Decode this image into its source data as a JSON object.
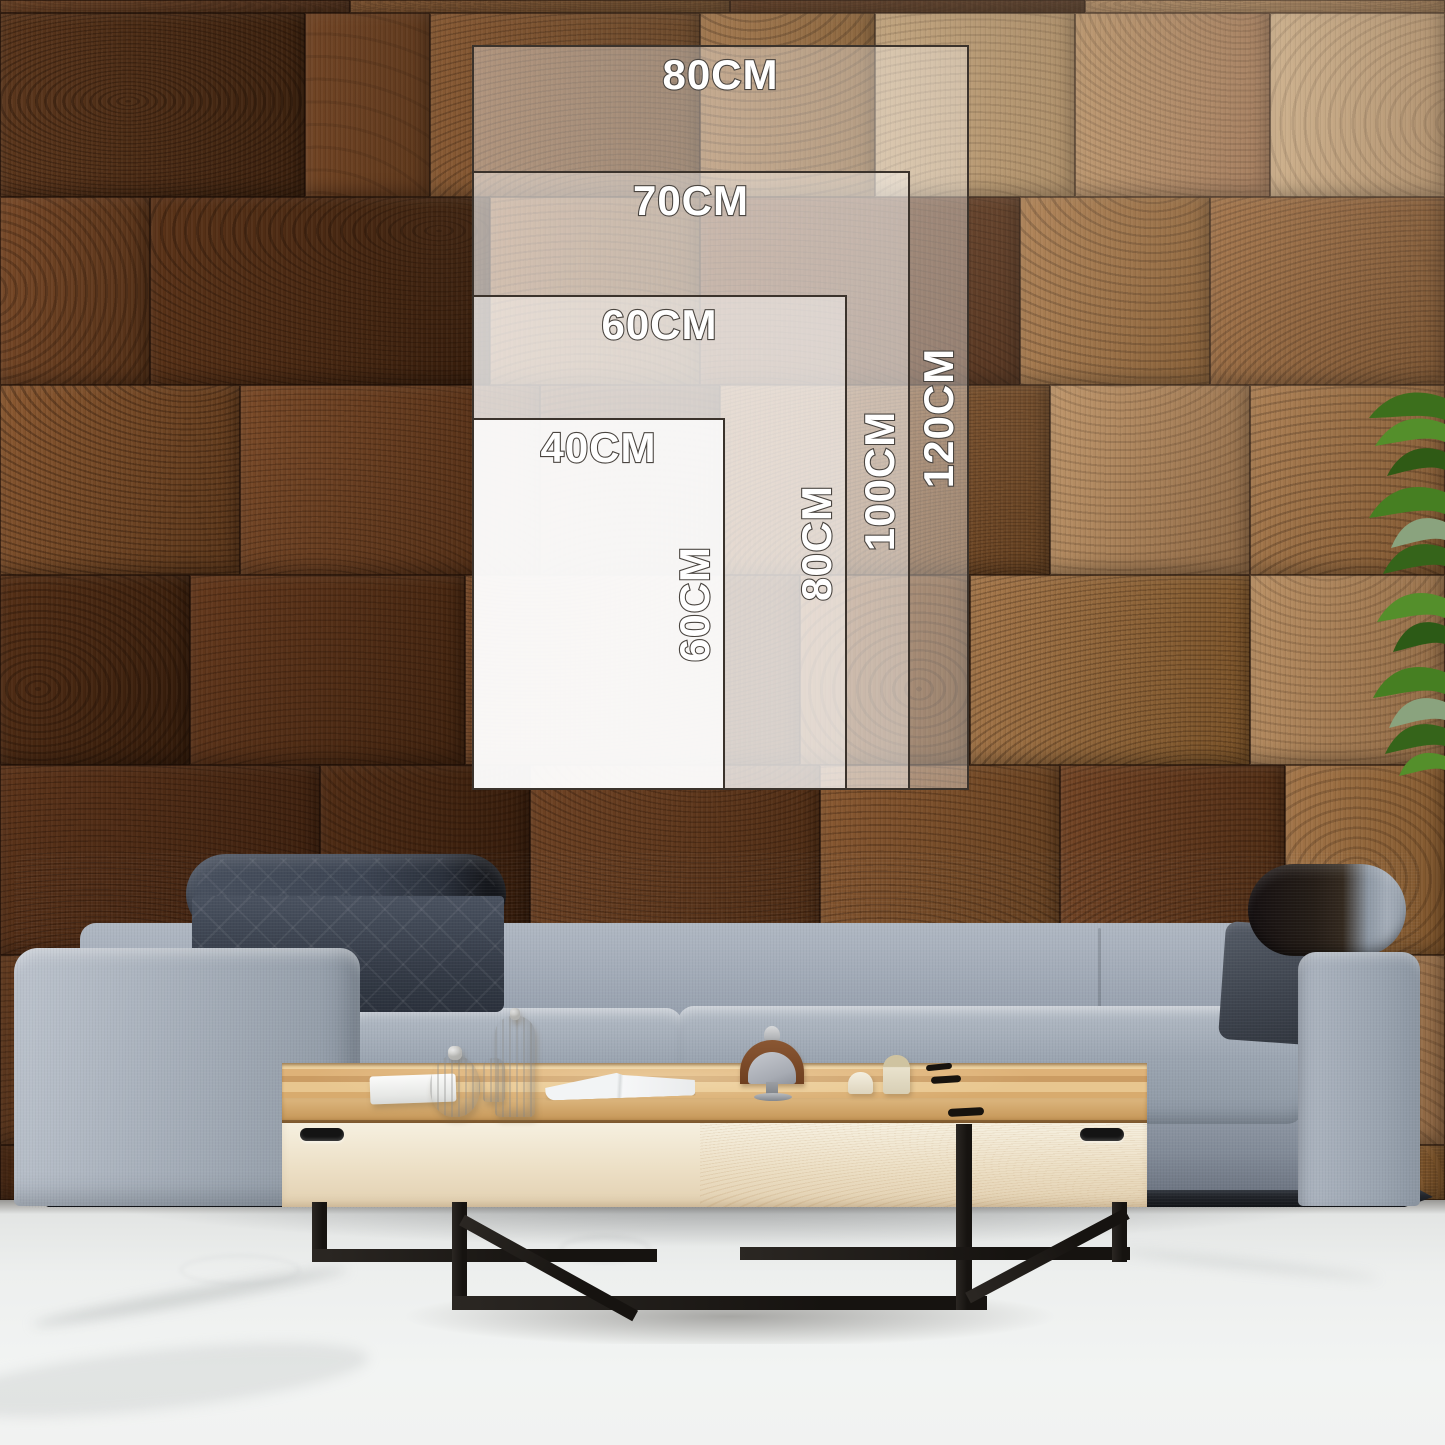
{
  "size_guide": {
    "overlay_color": "#ffffff",
    "border_color": "#3b332c",
    "label_text_color": "#ffffff",
    "label_outline_color": "#4a4540",
    "sizes": [
      {
        "id": "80x120",
        "width_label": "80CM",
        "height_label": "120CM"
      },
      {
        "id": "70x100",
        "width_label": "70CM",
        "height_label": "100CM"
      },
      {
        "id": "60x80",
        "width_label": "60CM",
        "height_label": "80CM"
      },
      {
        "id": "40x60",
        "width_label": "40CM",
        "height_label": "60CM"
      }
    ]
  },
  "scene": {
    "colors": {
      "wall_wood_mid": "#7a4a28",
      "wall_wood_dark": "#4a2b16",
      "wall_wood_pale": "#c7a87f",
      "sofa_fabric": "#9aa4b0",
      "headrest_quilt": "#3c4450",
      "bolster_leather": "#241c16",
      "table_wood": "#ddb379",
      "table_base": "#f1e8d6",
      "table_legs": "#1f1c19",
      "floor": "#edefee",
      "plant_leaf": "#4c8a28"
    }
  }
}
